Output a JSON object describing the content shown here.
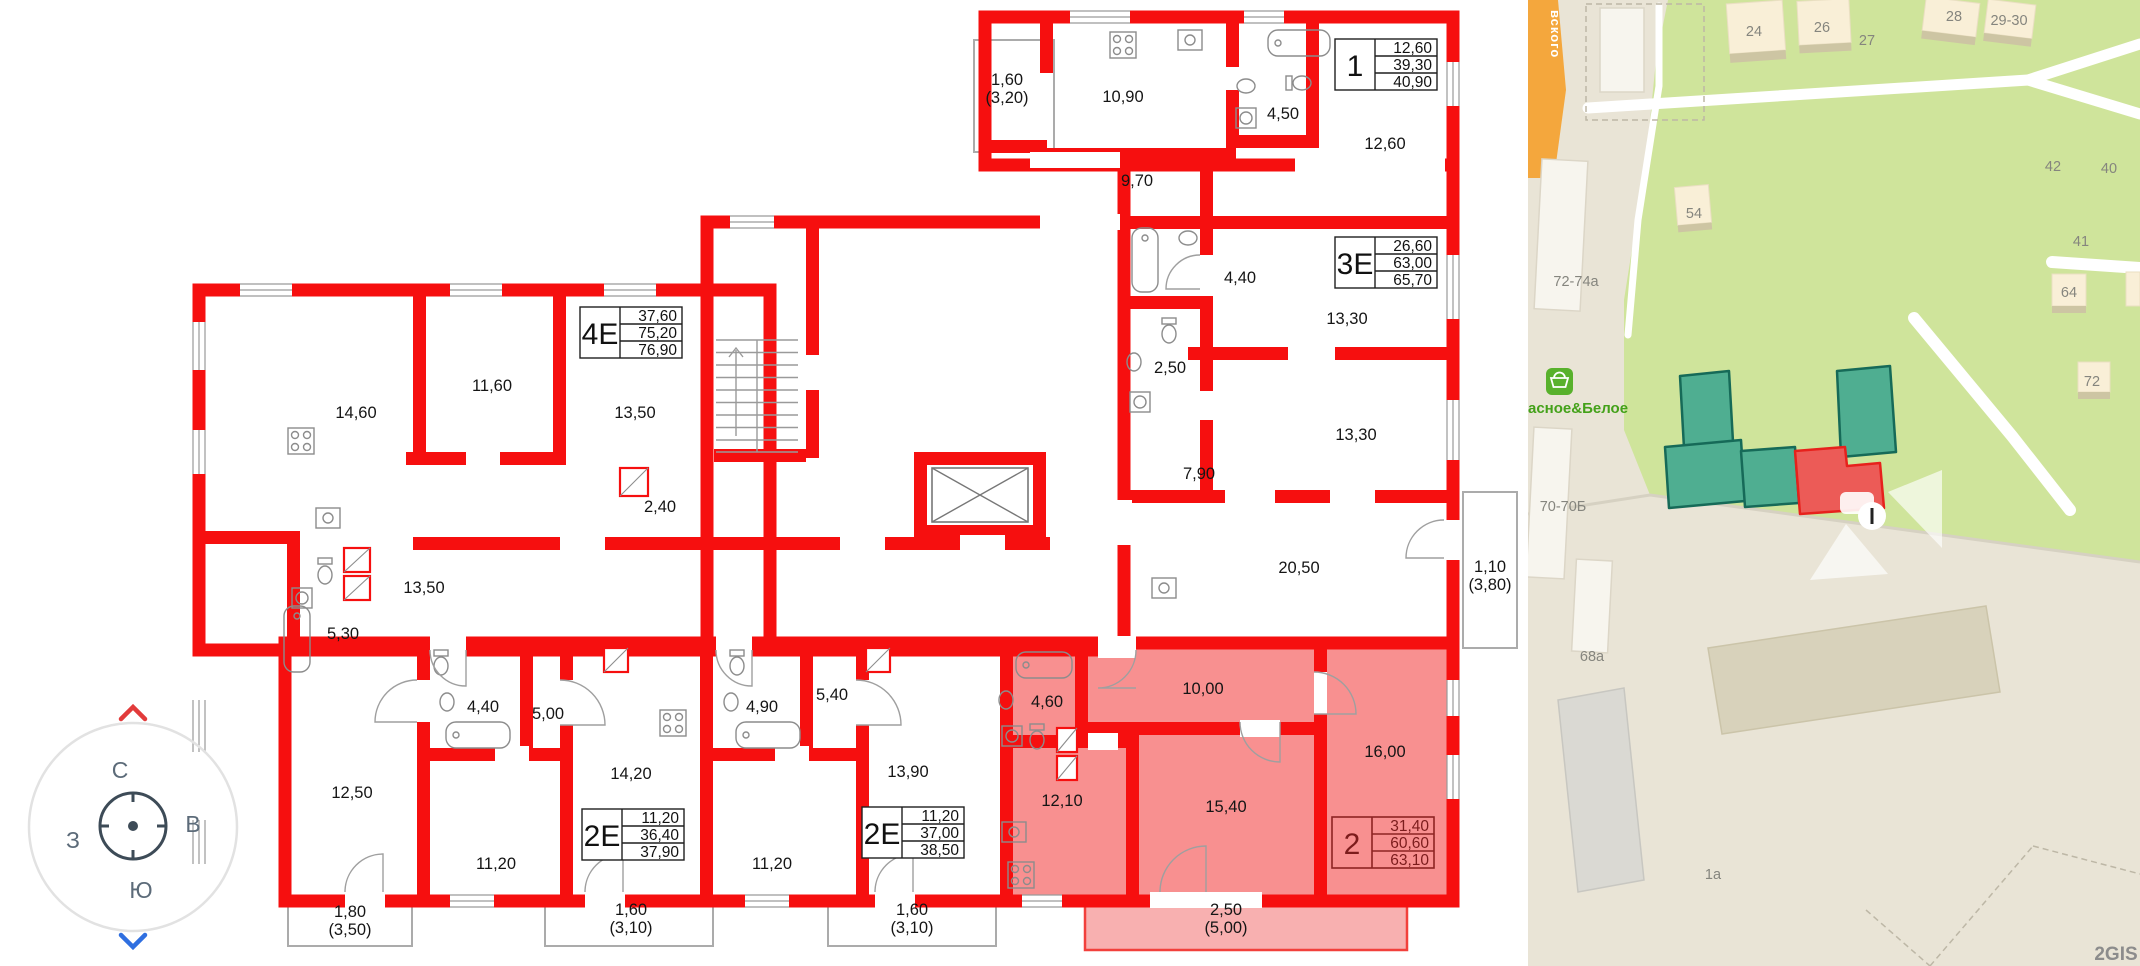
{
  "plan": {
    "room_labels": [
      {
        "text": "1,60"
      },
      {
        "text": "(3,20)"
      },
      {
        "text": "10,90"
      },
      {
        "text": "4,50"
      },
      {
        "text": "12,60"
      },
      {
        "text": "9,70"
      },
      {
        "text": "4,40"
      },
      {
        "text": "13,30"
      },
      {
        "text": "2,50"
      },
      {
        "text": "13,30"
      },
      {
        "text": "7,90"
      },
      {
        "text": "20,50"
      },
      {
        "text": "1,10"
      },
      {
        "text": "(3,80)"
      },
      {
        "text": "14,60"
      },
      {
        "text": "11,60"
      },
      {
        "text": "13,50"
      },
      {
        "text": "2,40"
      },
      {
        "text": "13,50"
      },
      {
        "text": "5,30"
      },
      {
        "text": "12,50"
      },
      {
        "text": "4,40"
      },
      {
        "text": "5,00"
      },
      {
        "text": "14,20"
      },
      {
        "text": "11,20"
      },
      {
        "text": "1,80"
      },
      {
        "text": "(3,50)"
      },
      {
        "text": "1,60"
      },
      {
        "text": "(3,10)"
      },
      {
        "text": "4,90"
      },
      {
        "text": "5,40"
      },
      {
        "text": "13,90"
      },
      {
        "text": "11,20"
      },
      {
        "text": "1,60"
      },
      {
        "text": "(3,10)"
      },
      {
        "text": "4,60"
      },
      {
        "text": "10,00"
      },
      {
        "text": "16,00"
      },
      {
        "text": "15,40"
      },
      {
        "text": "12,10"
      },
      {
        "text": "2,50"
      },
      {
        "text": "(5,00)"
      }
    ],
    "apartments": [
      {
        "type": "1",
        "area_living": "12,60",
        "area_main": "39,30",
        "area_total": "40,90"
      },
      {
        "type": "3Е",
        "area_living": "26,60",
        "area_main": "63,00",
        "area_total": "65,70"
      },
      {
        "type": "4Е",
        "area_living": "37,60",
        "area_main": "75,20",
        "area_total": "76,90"
      },
      {
        "type": "2Е",
        "area_living": "11,20",
        "area_main": "36,40",
        "area_total": "37,90"
      },
      {
        "type": "2Е",
        "area_living": "11,20",
        "area_main": "37,00",
        "area_total": "38,50"
      },
      {
        "type": "2",
        "area_living": "31,40",
        "area_main": "60,60",
        "area_total": "63,10"
      }
    ],
    "colors": {
      "wall": "#f60f0f",
      "highlight_fill": "#f89090",
      "highlight_balcony": "#f8b0b0"
    }
  },
  "compass": {
    "north": "С",
    "south": "Ю",
    "west": "З",
    "east": "В"
  },
  "map": {
    "street_label": "вского",
    "shop_label": "асное&Белое",
    "building_labels": {
      "b1": "72-74а",
      "b2": "70-70Б",
      "b3": "68а",
      "b4": "1а",
      "b5": "54",
      "b6": "24",
      "b7": "26",
      "b8": "27",
      "b9": "28",
      "b10": "29-30",
      "b11": "42",
      "b12": "40",
      "b13": "41",
      "b14": "64",
      "b15": "72"
    },
    "logo": "2GIS",
    "colors": {
      "selected_building": "#4fae91",
      "selected_section": "#ec5b57",
      "road": "#f4a73d",
      "park": "#cfe49b"
    }
  }
}
